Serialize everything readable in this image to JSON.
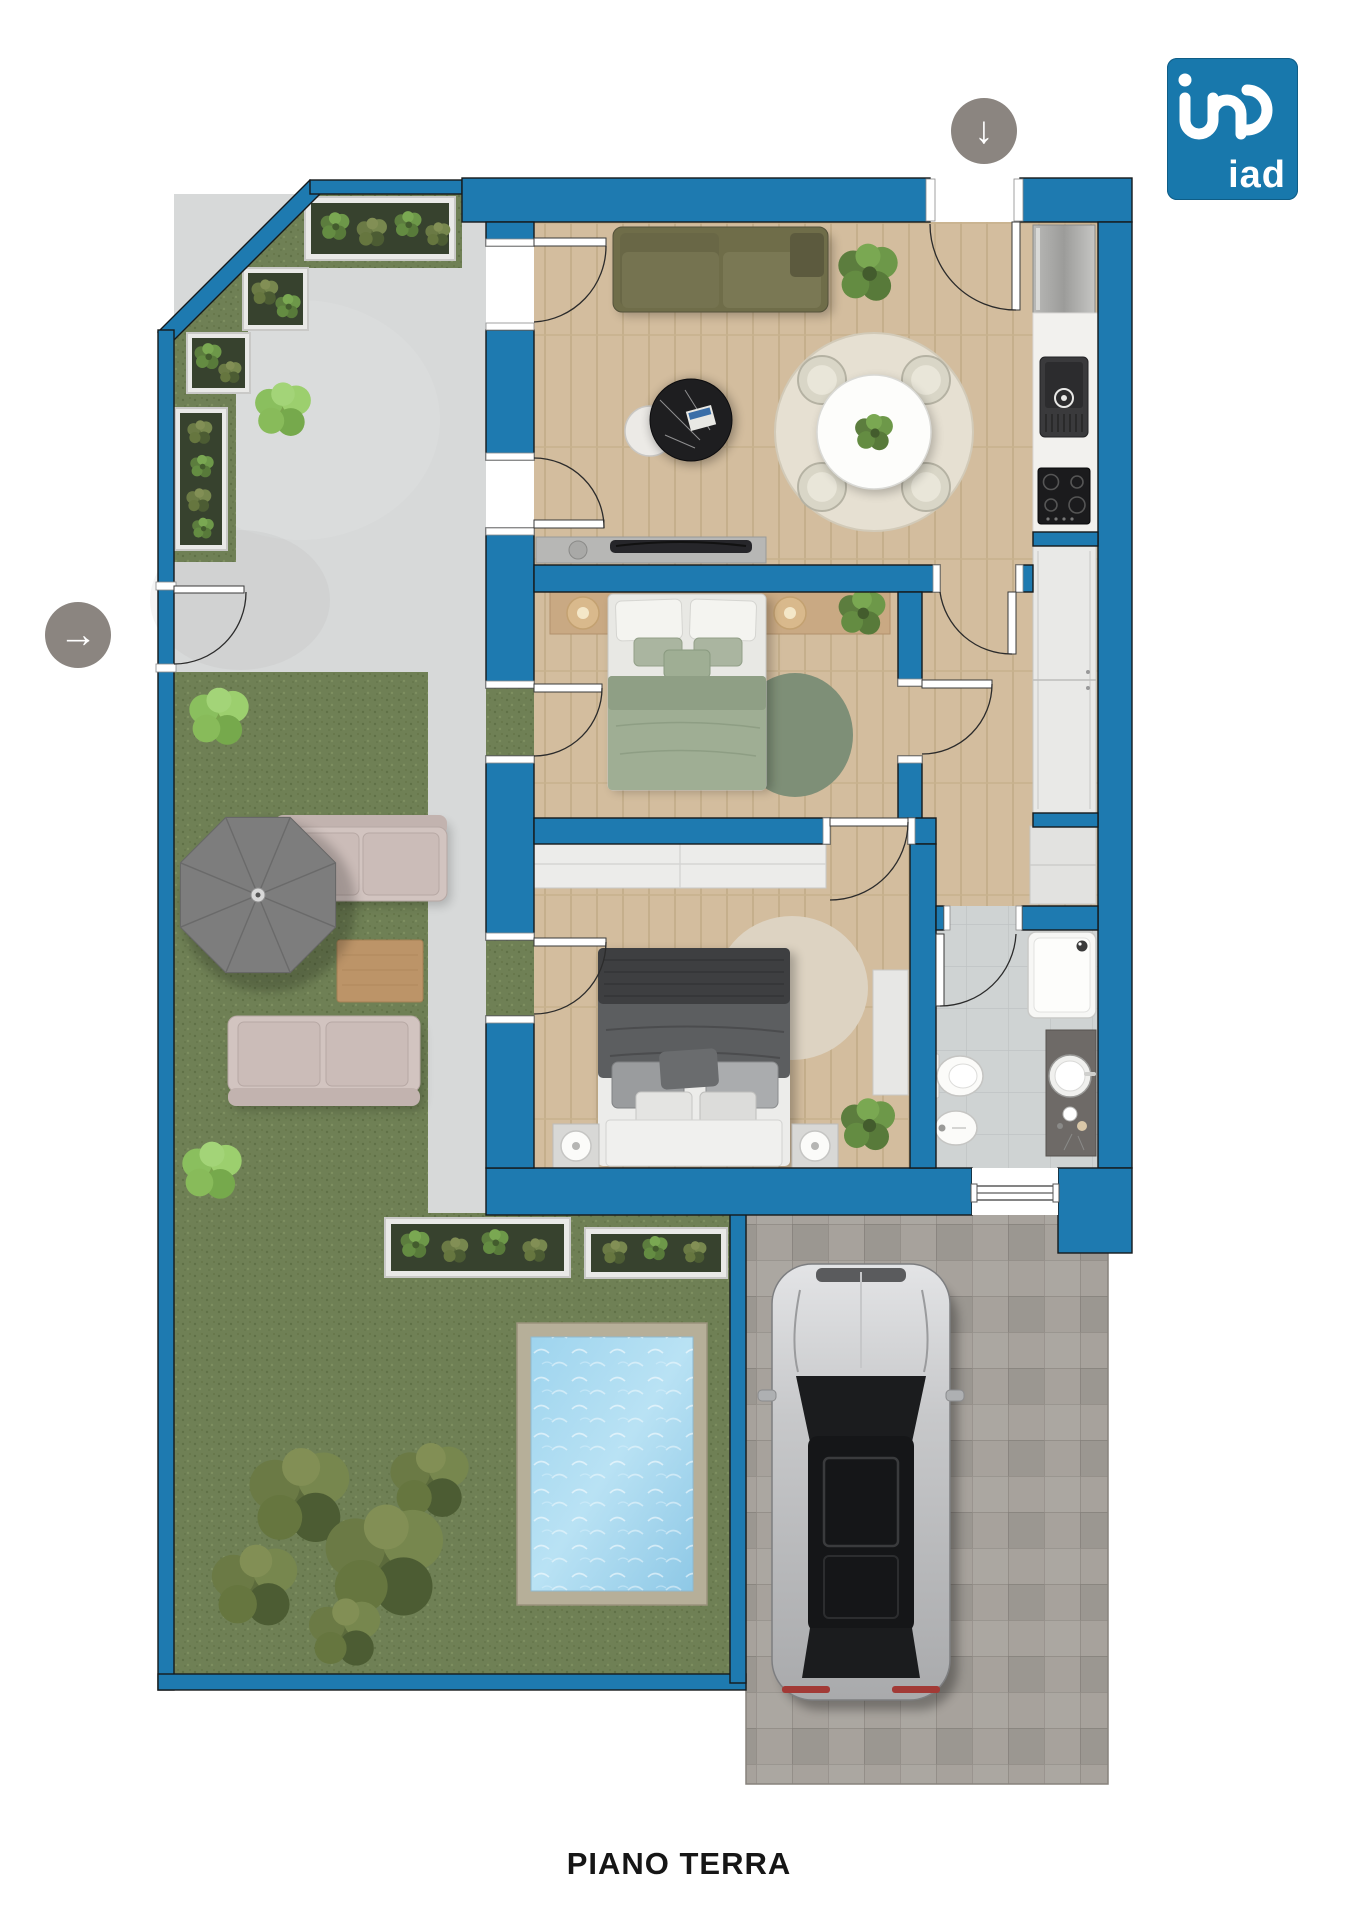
{
  "title": "PIANO TERRA",
  "brand": {
    "name": "iad",
    "logo_bg": "#1878ac"
  },
  "icons": {
    "top_entrance": {
      "name": "arrow-down-icon",
      "glyph": "↓"
    },
    "side_entrance": {
      "name": "arrow-right-icon",
      "glyph": "→"
    }
  },
  "palette": {
    "wall_blue": "#1e7ab0",
    "wood_floor": "#d3bd9e",
    "grass": "#6f8055",
    "concrete_patio": "#d7d9d9",
    "bathroom_tile": "#cfd3d3",
    "driveway_paving": "#a7a29c",
    "pool_water": "#a9d9ef",
    "arrow_gray": "#8b8580"
  },
  "floorplan": {
    "floor_label": "PIANO TERRA",
    "rooms": [
      {
        "name": "living-room-kitchen",
        "furniture": [
          "olive-sofa",
          "black-coffee-table",
          "white-side-table",
          "dining-table-with-plant",
          "four-chairs",
          "round-rug",
          "tv-sideboard",
          "fridge",
          "kitchen-counter",
          "sink",
          "cooktop",
          "plant"
        ]
      },
      {
        "name": "bedroom-1",
        "furniture": [
          "green-double-bed",
          "headboard-shelf",
          "two-lamps",
          "round-green-rug",
          "plant"
        ]
      },
      {
        "name": "bedroom-2",
        "furniture": [
          "dark-double-bed",
          "long-wardrobe",
          "two-nightstands",
          "two-lamps",
          "round-beige-rug",
          "side-cabinet",
          "plant"
        ]
      },
      {
        "name": "bathroom",
        "furniture": [
          "shower-tray",
          "toilet",
          "bidet",
          "vanity-with-round-sink"
        ]
      },
      {
        "name": "hallway",
        "furniture": [
          "tall-wardrobe",
          "cabinet"
        ]
      }
    ],
    "outdoor": [
      "concrete-patio",
      "garden-lawn",
      "parasol",
      "two-outdoor-sofas",
      "wooden-coffee-table",
      "planter-boxes",
      "bushes",
      "swimming-pool",
      "paved-driveway",
      "car"
    ]
  }
}
